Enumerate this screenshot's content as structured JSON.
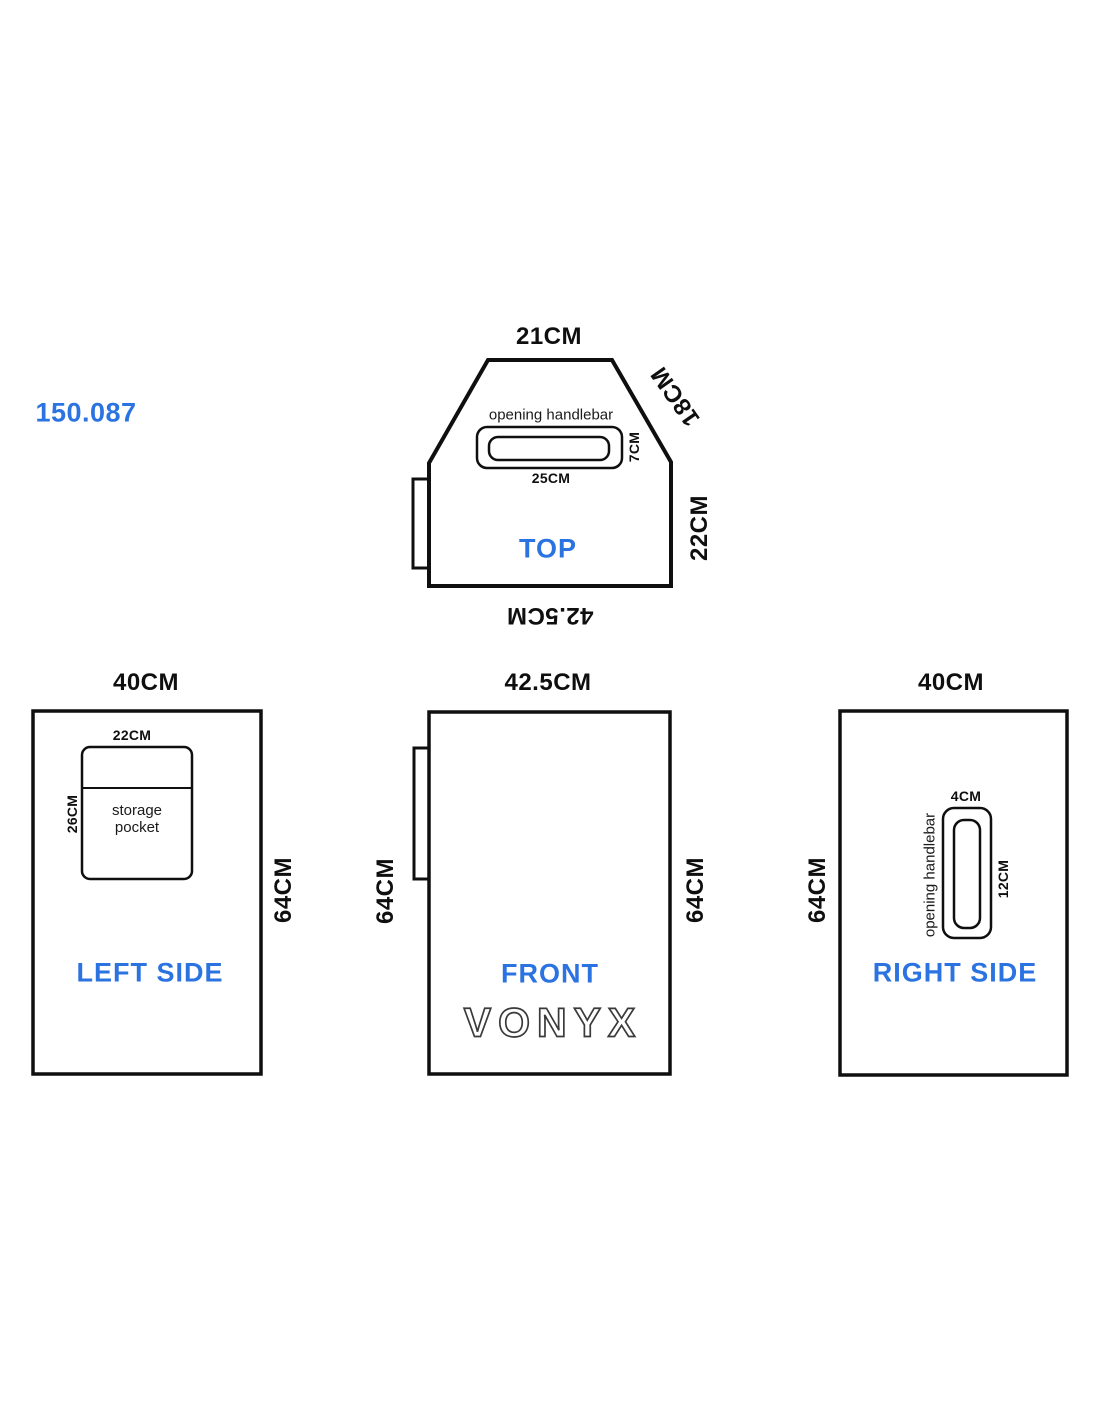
{
  "product_code": "150.087",
  "colors": {
    "accent": "#2c73e2",
    "line": "#0f0f0f"
  },
  "views": {
    "top": {
      "label": "TOP",
      "dim_top": "21CM",
      "dim_diagonal": "18CM",
      "dim_right": "22CM",
      "dim_bottom": "42.5CM",
      "handle_label": "opening handlebar",
      "handle_width": "25CM",
      "handle_height": "7CM"
    },
    "left_side": {
      "label": "LEFT SIDE",
      "dim_top": "40CM",
      "dim_right": "64CM",
      "pocket_label": "storage pocket",
      "pocket_width": "22CM",
      "pocket_height": "26CM"
    },
    "front": {
      "label": "FRONT",
      "dim_top": "42.5CM",
      "dim_left": "64CM",
      "dim_right": "64CM",
      "brand": "VONYX"
    },
    "right_side": {
      "label": "RIGHT SIDE",
      "dim_top": "40CM",
      "dim_left": "64CM",
      "handle_label": "opening handlebar",
      "handle_width": "4CM",
      "handle_height": "12CM"
    }
  }
}
